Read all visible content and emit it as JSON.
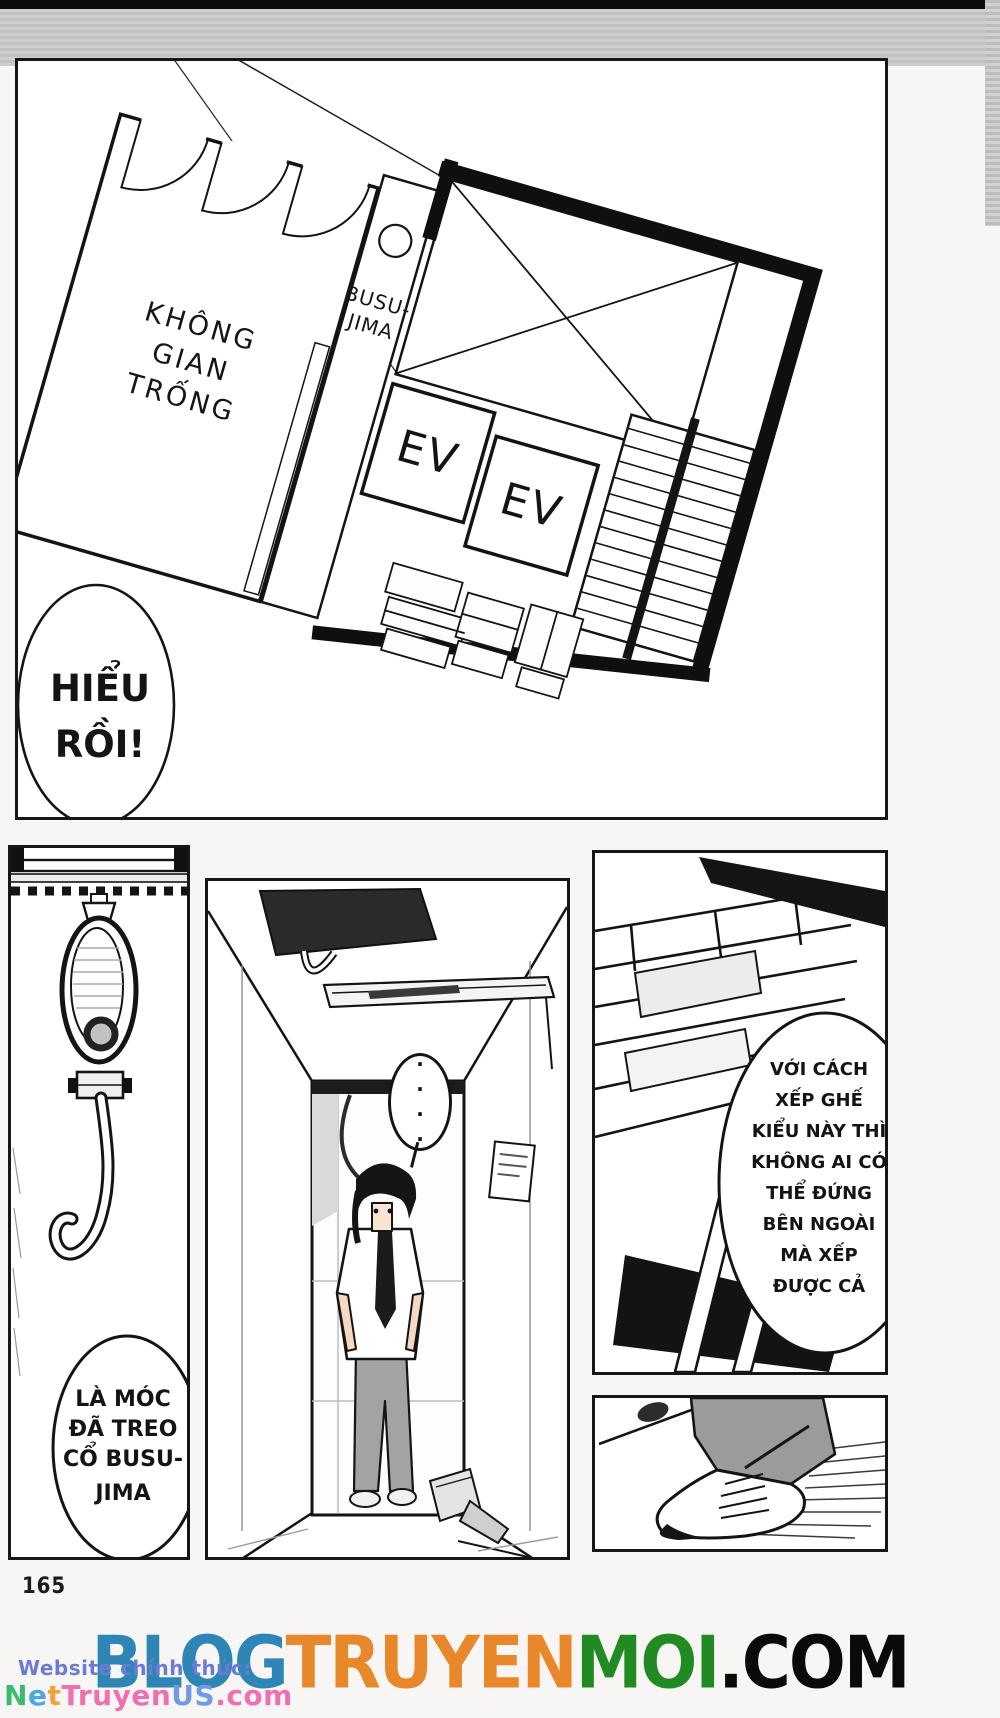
{
  "page_number": "165",
  "floorplan_panel": {
    "room_label": [
      "KHÔNG",
      "GIAN",
      "TRỐNG"
    ],
    "busujima_label": [
      "BUSU-",
      "JIMA"
    ],
    "elevator_1": "EV",
    "elevator_2": "EV",
    "speech_bubble": [
      "HIỂU",
      "RỒI!"
    ]
  },
  "hook_panel": {
    "speech_bubble": [
      "LÀ MÓC",
      "ĐÃ TREO",
      "CỔ BUSU-",
      "JIMA"
    ]
  },
  "hallway_panel": {
    "ellipsis_dots": "····"
  },
  "chairs_panel": {
    "speech_bubble": [
      "VỚI CÁCH",
      "XẾP GHẾ",
      "KIỂU NÀY THÌ",
      "KHÔNG AI CÓ",
      "THỂ ĐỨNG",
      "BÊN NGOÀI",
      "MÀ XẾP",
      "ĐƯỢC CẢ"
    ]
  },
  "footer": {
    "logo_segments": [
      {
        "text": "BLOG",
        "style": "color:#2d86b5"
      },
      {
        "text": "TRUYEN",
        "style": "color:#e8882b"
      },
      {
        "text": "MOI",
        "style": "color:#228a22"
      },
      {
        "text": ".COM",
        "style": "color:#0a0a0a"
      }
    ],
    "watermark": {
      "text": "Website chính thức:",
      "style": "color:#6b7bd4"
    },
    "site_segments": [
      {
        "text": "N",
        "style": "color:#3cba70"
      },
      {
        "text": "e",
        "style": "color:#49a8e6"
      },
      {
        "text": "t",
        "style": "color:#f0a13a"
      },
      {
        "text": "Truyen",
        "style": "color:#f06fb0"
      },
      {
        "text": "US",
        "style": "color:#6f9be6"
      },
      {
        "text": ".com",
        "style": "color:#f06fb0"
      }
    ]
  }
}
